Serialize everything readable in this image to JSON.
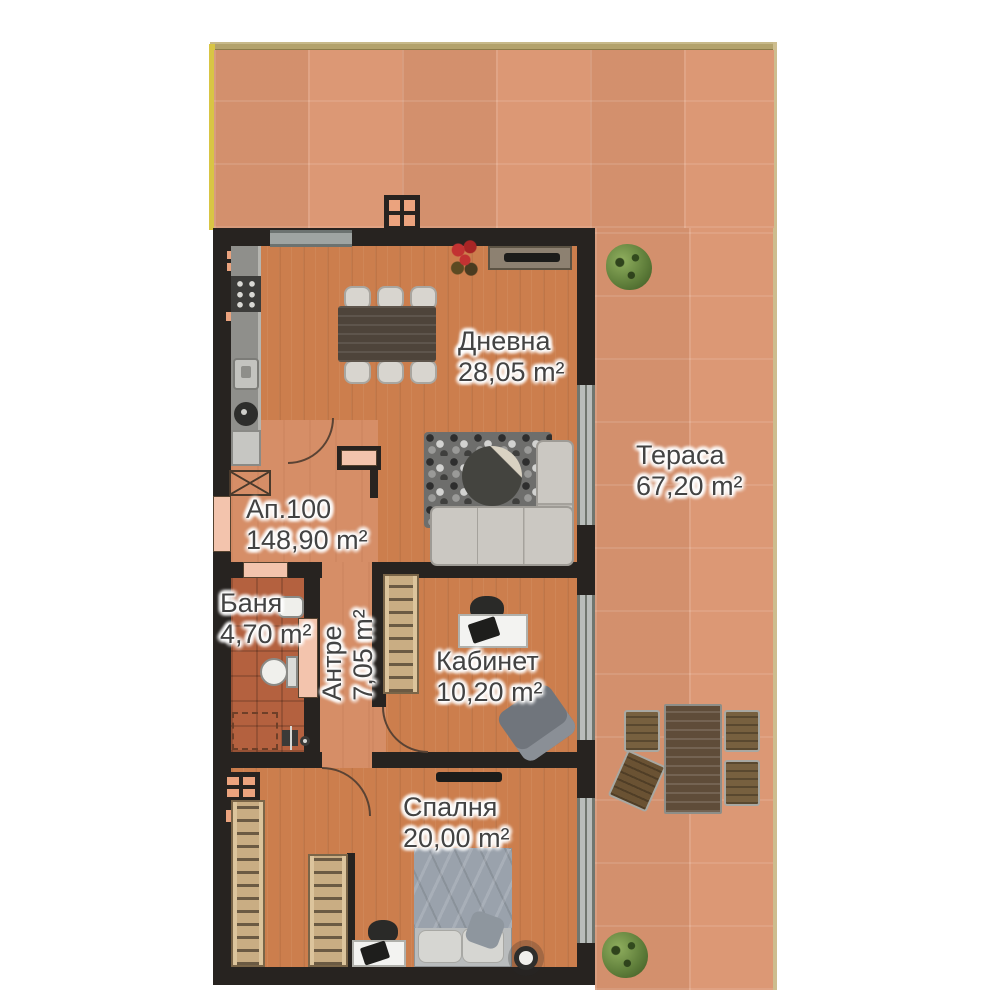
{
  "rooms": {
    "dnevna": {
      "name": "Дневна",
      "area": "28,05 m²"
    },
    "terasa": {
      "name": "Тераса",
      "area": "67,20 m²"
    },
    "ap100": {
      "name": "Ап.100",
      "area": "148,90 m²"
    },
    "banya": {
      "name": "Баня",
      "area": "4,70 m²"
    },
    "antre": {
      "name": "Антре",
      "area": "7,05 m²"
    },
    "kabinet": {
      "name": "Кабинет",
      "area": "10,20 m²"
    },
    "spalnya": {
      "name": "Спалня",
      "area": "20,00 m²"
    }
  },
  "colors": {
    "terrace_tile": "#db9571",
    "wood_floor": "#cc7e4d",
    "hall_floor": "#d68e67",
    "bath_floor": "#b4613f",
    "wall": "#272320",
    "door_opening": "#f3c4ad",
    "terrace_border": "#b3a26c",
    "accent_yellow": "#d8c544",
    "label_text": "#434343"
  }
}
